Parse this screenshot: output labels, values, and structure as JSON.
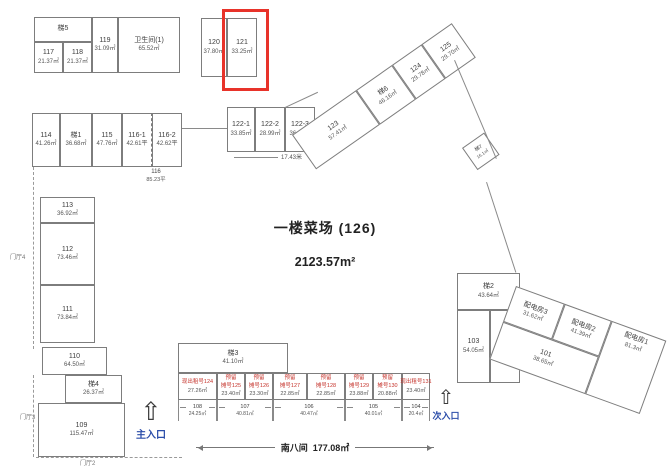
{
  "market": {
    "title": "一楼菜场 (126)",
    "area": "2123.57m²"
  },
  "rooms": {
    "t5": {
      "id": "梯5",
      "area": ""
    },
    "r117": {
      "id": "117",
      "area": "21.37㎡"
    },
    "r118": {
      "id": "118",
      "area": "21.37㎡"
    },
    "r119": {
      "id": "119",
      "area": "31.09㎡"
    },
    "wc1": {
      "id": "卫生间(1)",
      "area": "65.52㎡"
    },
    "r120": {
      "id": "120",
      "area": "37.80㎡"
    },
    "r121": {
      "id": "121",
      "area": "33.25㎡"
    },
    "r114": {
      "id": "114",
      "area": "41.26㎡"
    },
    "t1": {
      "id": "梯1",
      "area": "36.68㎡"
    },
    "r115": {
      "id": "115",
      "area": "47.76㎡"
    },
    "r116_1": {
      "id": "116-1",
      "area": "42.61平"
    },
    "r116_2": {
      "id": "116-2",
      "area": "42.62平"
    },
    "r113": {
      "id": "113",
      "area": "36.92㎡"
    },
    "r112": {
      "id": "112",
      "area": "73.46㎡"
    },
    "r111": {
      "id": "111",
      "area": "73.84㎡"
    },
    "r110": {
      "id": "110",
      "area": "64.50㎡"
    },
    "t4": {
      "id": "梯4",
      "area": "26.37㎡"
    },
    "r109": {
      "id": "109",
      "area": "115.47㎡"
    },
    "r122_1": {
      "id": "122-1",
      "area": "33.85㎡"
    },
    "r122_2": {
      "id": "122-2",
      "area": "28.99㎡"
    },
    "r122_3": {
      "id": "122-3",
      "area": "36.12㎡"
    },
    "r123": {
      "id": "123",
      "area": "57.41㎡"
    },
    "t6": {
      "id": "梯6",
      "area": "46.16㎡"
    },
    "r124": {
      "id": "124",
      "area": "29.78㎡"
    },
    "r125": {
      "id": "125",
      "area": "29.70㎡"
    },
    "t7": {
      "id": "梯7",
      "area": "16.1㎡"
    },
    "t2": {
      "id": "梯2",
      "area": "43.64㎡"
    },
    "r103": {
      "id": "103",
      "area": "54.05㎡"
    },
    "r102": {
      "id": "102",
      "area": "57.63㎡"
    },
    "pd3": {
      "id": "配电房3",
      "area": "31.62㎡"
    },
    "pd2": {
      "id": "配电房2",
      "area": "41.39㎡"
    },
    "pd1": {
      "id": "配电房1",
      "area": "81.3㎡"
    },
    "r101": {
      "id": "101",
      "area": "38.65㎡"
    },
    "t3": {
      "id": "梯3",
      "area": "41.10㎡"
    }
  },
  "stalls": {
    "s124": {
      "line1": "现出租号124",
      "area": "27.26㎡"
    },
    "s125": {
      "line1": "预留",
      "line2": "摊号125",
      "area": "23.40㎡"
    },
    "s126": {
      "line1": "预留",
      "line2": "摊号126",
      "area": "23.30㎡"
    },
    "s127": {
      "line1": "预留",
      "line2": "摊号127",
      "area": "22.85㎡"
    },
    "s128": {
      "line1": "预留",
      "line2": "摊号128",
      "area": "22.85㎡"
    },
    "s129": {
      "line1": "预留",
      "line2": "摊号129",
      "area": "23.88㎡"
    },
    "s130": {
      "line1": "预留",
      "line2": "摊号130",
      "area": "20.88㎡"
    },
    "s131": {
      "line1": "现出租号131",
      "area": "23.40㎡"
    }
  },
  "dims": {
    "d108": {
      "id": "108",
      "area": "24.25㎡"
    },
    "d107": {
      "id": "107",
      "area": "40.81㎡"
    },
    "d106": {
      "id": "106",
      "area": "40.47㎡"
    },
    "d105": {
      "id": "105",
      "area": "40.01㎡"
    },
    "d104": {
      "id": "104",
      "area": "20.4㎡"
    },
    "south": {
      "label": "南八间",
      "area": "177.08㎡"
    },
    "d116": {
      "id": "116",
      "area": "85.23平"
    },
    "d17": "17.43米"
  },
  "lobbies": {
    "l4": "门厅4",
    "l3": "门厅3",
    "l2": "门厅2"
  },
  "entrances": {
    "main": "主入口",
    "secondary": "次入口",
    "arrow": "⇧"
  },
  "colors": {
    "highlight_box": "#e8332a",
    "stall_text": "#c5332b",
    "entrance_text": "#2b4da9"
  }
}
